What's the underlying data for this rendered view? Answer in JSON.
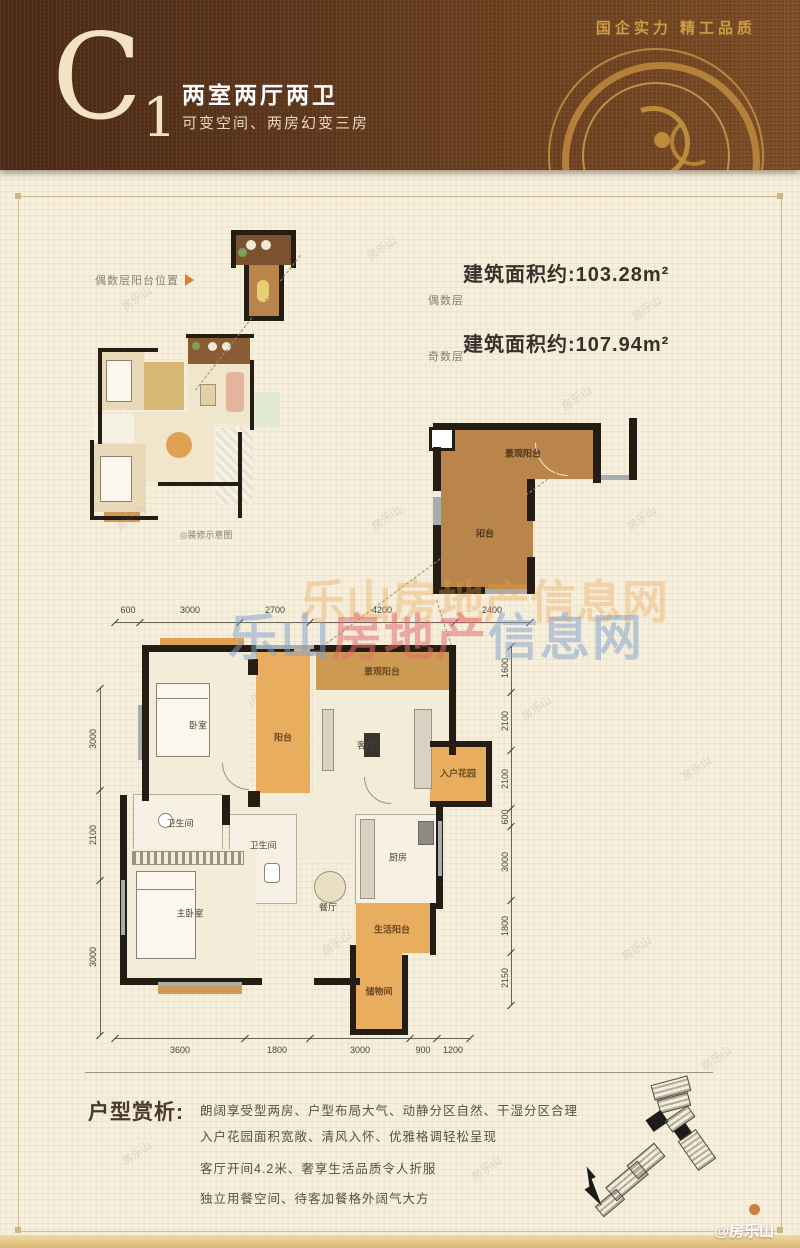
{
  "header": {
    "code": "C",
    "code_sub": "1",
    "title": "两室两厅两卫",
    "subtitle": "可变空间、两房幻变三房",
    "slogan": "国企实力 精工品质"
  },
  "floor_areas": {
    "even_label": "偶数层",
    "even_area": "建筑面积约:103.28m²",
    "odd_label": "奇数层",
    "odd_area": "建筑面积约:107.94m²"
  },
  "annotations": {
    "balcony_position_label": "偶数层阳台位置",
    "schematic_caption": "◎装修示意图"
  },
  "balcony_detail": {
    "label_top": "景观阳台",
    "label_main": "阳台"
  },
  "main_plan": {
    "rooms": {
      "top_balcony": "景观阳台",
      "bedroom": "卧室",
      "balcony": "阳台",
      "living": "客厅",
      "entry_garden": "入户花园",
      "bath1": "卫生间",
      "bath2": "卫生间",
      "master": "主卧室",
      "dining": "餐厅",
      "kitchen": "厨房",
      "life_balcony": "生活阳台",
      "storage": "储物间"
    },
    "dims_top": [
      "600",
      "3000",
      "2700",
      "4200",
      "2400"
    ],
    "dims_bottom": [
      "3600",
      "1800",
      "3000",
      "900",
      "1200"
    ],
    "dims_left": [
      "3000",
      "2100",
      "3000"
    ],
    "dims_right": [
      "1600",
      "2100",
      "2100",
      "600",
      "3000",
      "1800",
      "2150"
    ]
  },
  "analysis": {
    "heading": "户型赏析:",
    "lines": [
      "朗阔享受型两房、户型布局大气、动静分区自然、干湿分区合理",
      "入户花园面积宽敞、清风入怀、优雅格调轻松呈现",
      "客厅开间4.2米、奢享生活品质令人折服",
      "独立用餐空间、待客加餐格外阔气大方"
    ]
  },
  "watermarks": {
    "brand_parts": [
      "乐山",
      "房地产",
      "信息网"
    ],
    "brand_orange": "乐山房地产信息网",
    "tile": "房乐山",
    "credit": "@房乐山"
  },
  "colors": {
    "header_brown": "#5a3420",
    "gold": "#c9973f",
    "accent_orange": "#e07b35",
    "balcony_orange": "#e9ad5f",
    "balcony_brown": "#b9854a"
  }
}
